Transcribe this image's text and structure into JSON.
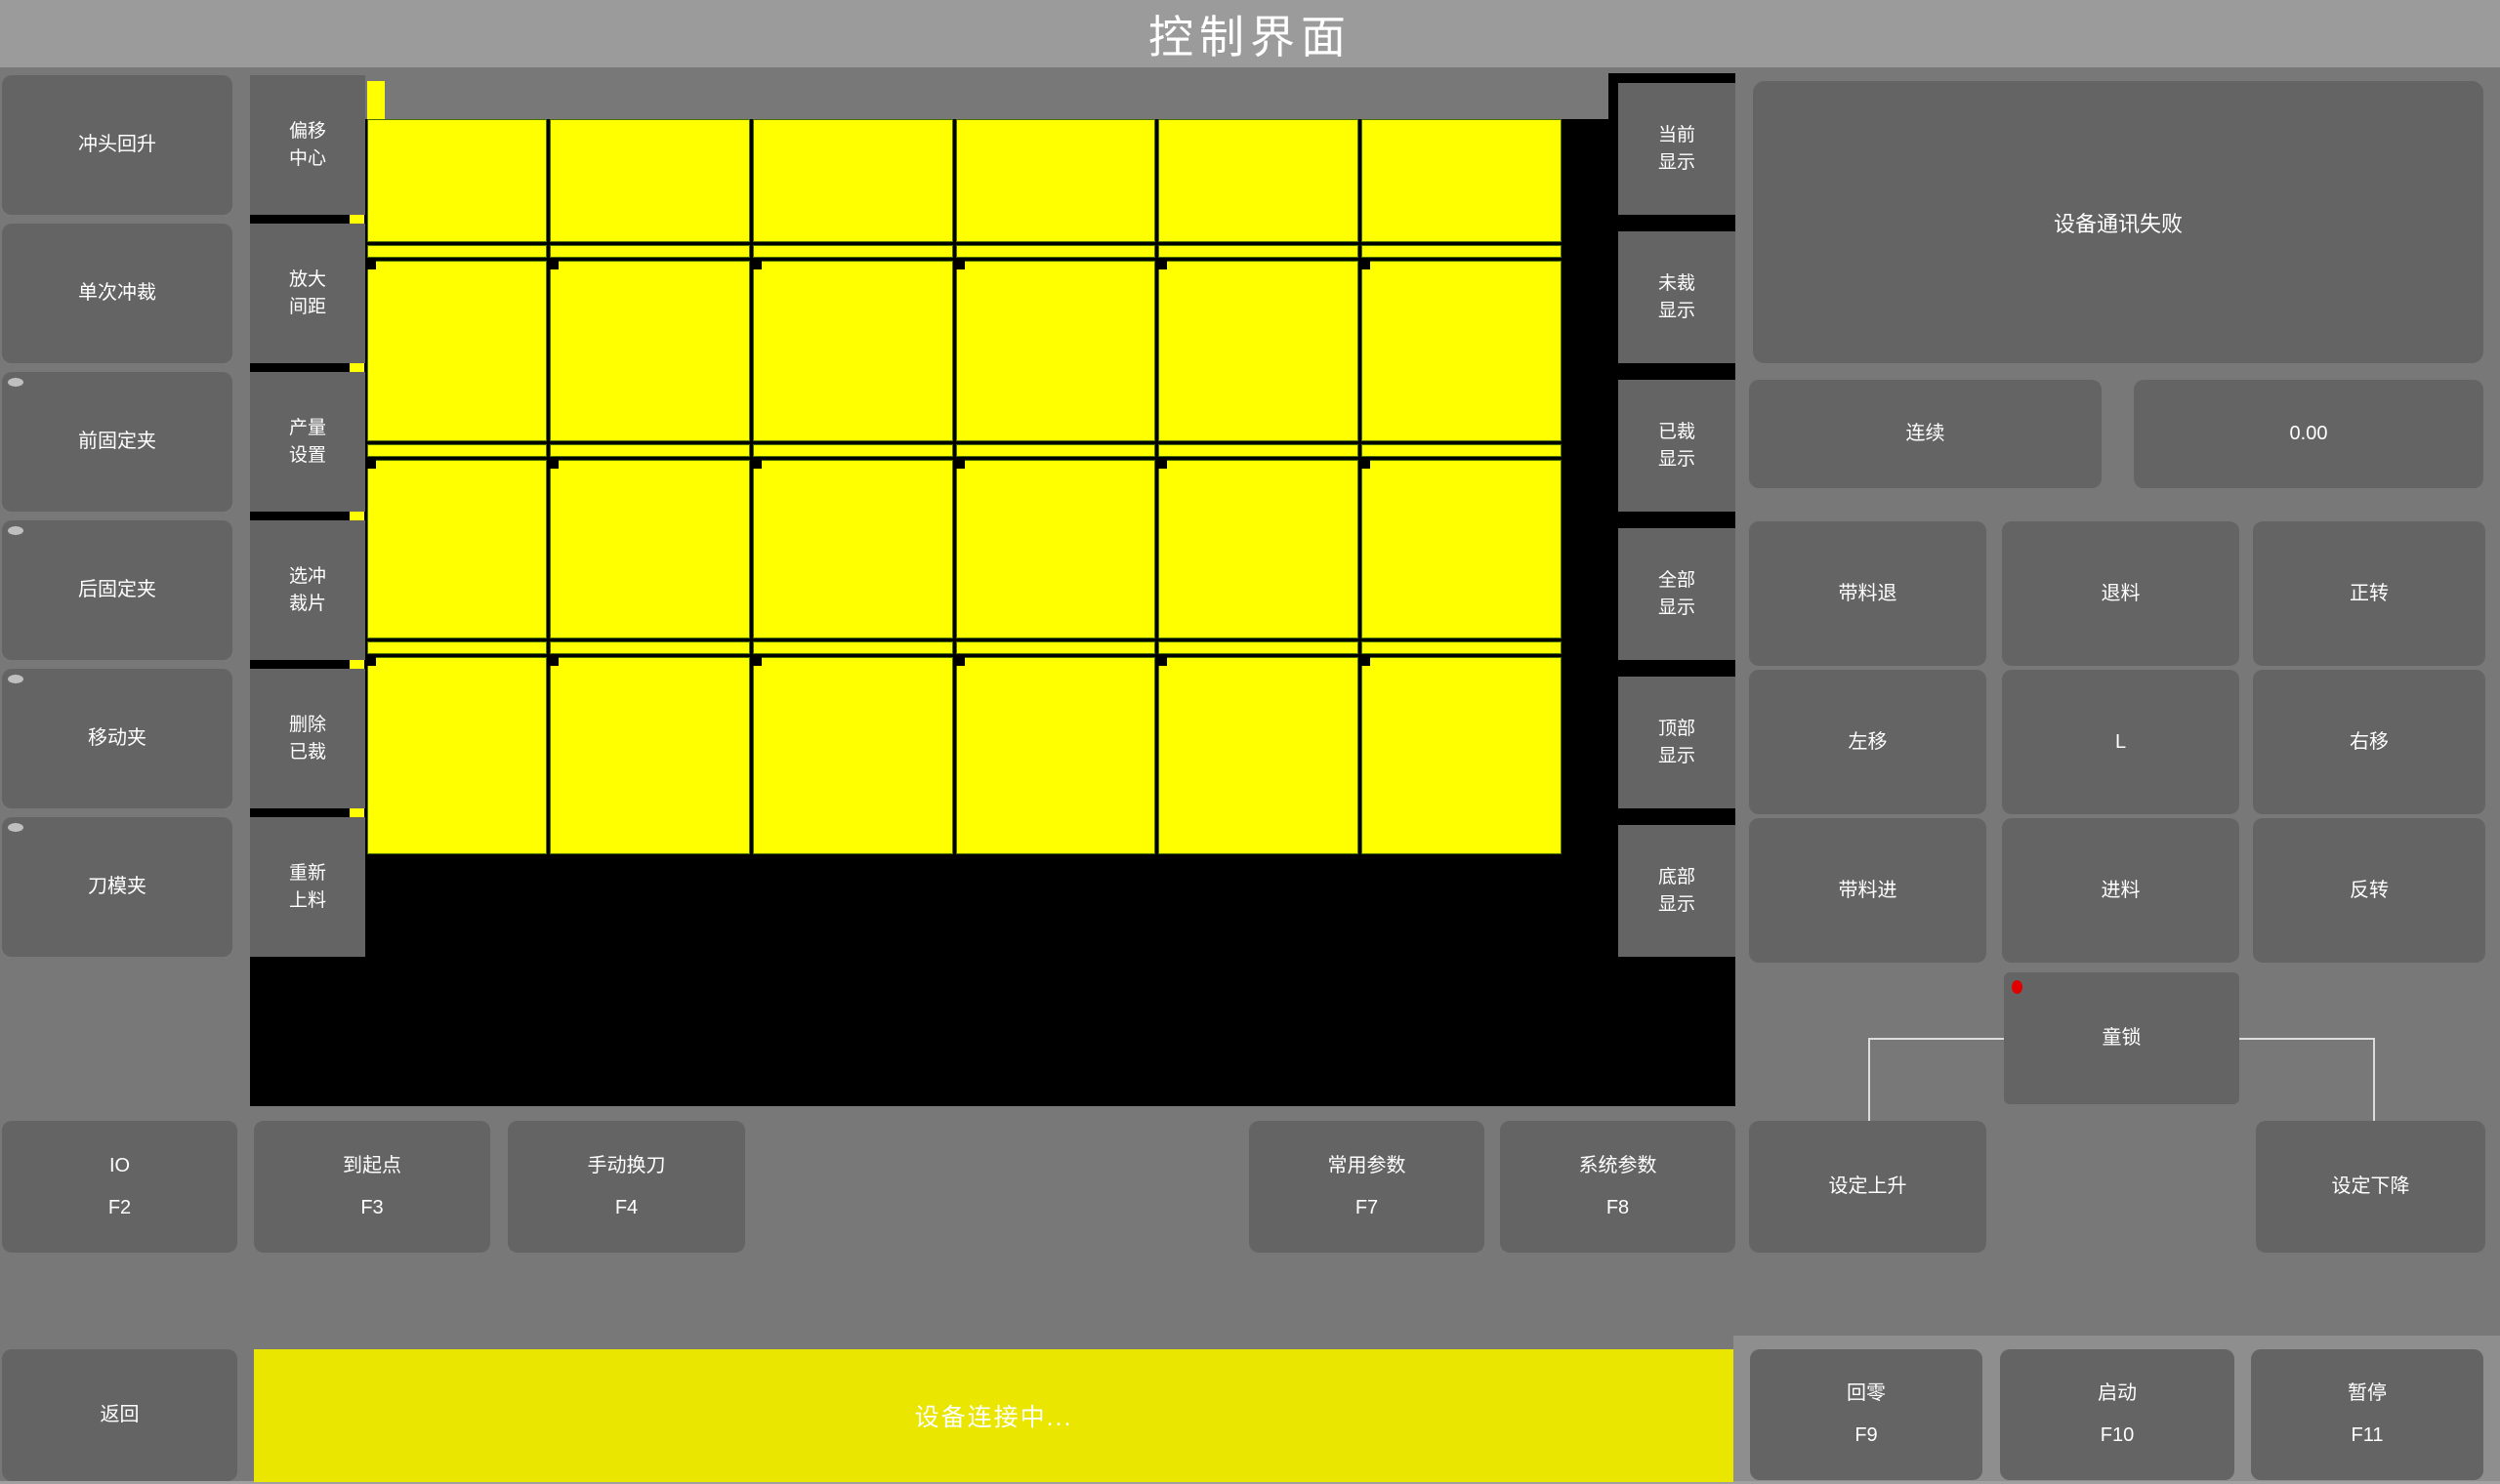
{
  "title": "控制界面",
  "left_panel": {
    "buttons": [
      {
        "label": "冲头回升",
        "indicator": false
      },
      {
        "label": "单次冲裁",
        "indicator": false
      },
      {
        "label": "前固定夹",
        "indicator": true
      },
      {
        "label": "后固定夹",
        "indicator": true
      },
      {
        "label": "移动夹",
        "indicator": true
      },
      {
        "label": "刀模夹",
        "indicator": true
      }
    ]
  },
  "tool_panel": {
    "buttons": [
      {
        "label": "偏移\n中心"
      },
      {
        "label": "放大\n间距"
      },
      {
        "label": "产量\n设置"
      },
      {
        "label": "选冲\n裁片"
      },
      {
        "label": "删除\n已裁"
      },
      {
        "label": "重新\n上料"
      }
    ]
  },
  "display_panel": {
    "buttons": [
      {
        "label": "当前\n显示"
      },
      {
        "label": "未裁\n显示"
      },
      {
        "label": "已裁\n显示"
      },
      {
        "label": "全部\n显示"
      },
      {
        "label": "顶部\n显示"
      },
      {
        "label": "底部\n显示"
      }
    ]
  },
  "material_view": {
    "columns": 6,
    "rows": 4,
    "piece_color": "#ffff00",
    "gap_color": "#000000",
    "piece_border_color": "#4a6f00",
    "background": "#000000"
  },
  "right_panel": {
    "status_message": "设备通讯失败",
    "mode_button": "连续",
    "value_display": "0.00",
    "jog_buttons": [
      "带料退",
      "退料",
      "正转",
      "左移",
      "L",
      "右移",
      "带料进",
      "进料",
      "反转"
    ],
    "child_lock_button": "童锁",
    "set_rise_button": "设定上升",
    "set_fall_button": "设定下降"
  },
  "function_row": {
    "buttons": [
      {
        "label": "IO",
        "key": "F2"
      },
      {
        "label": "到起点",
        "key": "F3"
      },
      {
        "label": "手动换刀",
        "key": "F4"
      },
      {
        "label": "常用参数",
        "key": "F7"
      },
      {
        "label": "系统参数",
        "key": "F8"
      }
    ]
  },
  "bottom_bar": {
    "back_button": "返回",
    "status_text": "设备连接中...",
    "buttons": [
      {
        "label": "回零",
        "key": "F9"
      },
      {
        "label": "启动",
        "key": "F10"
      },
      {
        "label": "暂停",
        "key": "F11"
      }
    ]
  },
  "colors": {
    "accent_yellow": "#ffff00",
    "status_bar_yellow": "#eae600",
    "indicator_red": "#e00000",
    "title_bar_gray": "#9b9b9b",
    "button_gray": "#646464"
  }
}
